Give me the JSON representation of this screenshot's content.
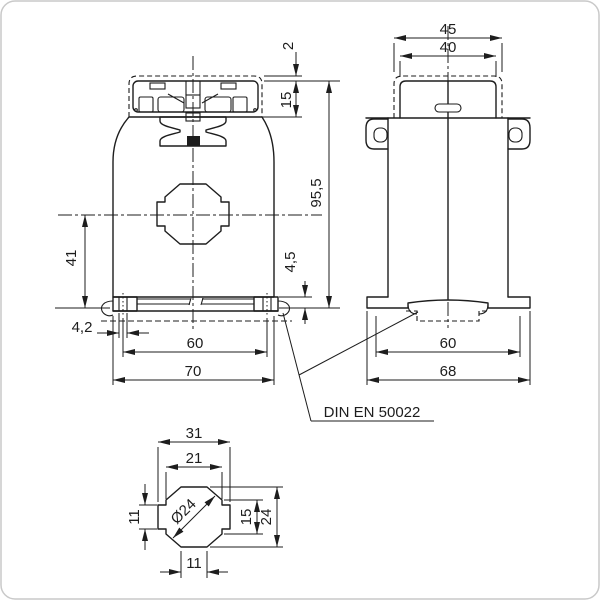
{
  "views": {
    "front": {
      "dims": {
        "gap2": "2",
        "h15": "15",
        "total": "95,5",
        "step": "4,5",
        "v41": "41",
        "slot": "4,2",
        "rail60": "60",
        "w70": "70"
      }
    },
    "side": {
      "dims": {
        "w45": "45",
        "w40": "40",
        "rail60": "60",
        "w68": "68"
      }
    },
    "detail": {
      "dims": {
        "w31": "31",
        "w21": "21",
        "dia": "Ø24",
        "h15": "15",
        "h24": "24",
        "h11": "11",
        "w11": "11"
      }
    },
    "note": {
      "standard": "DIN EN 50022"
    }
  },
  "colors": {
    "line": "#1d1d1d",
    "background": "#ffffff"
  }
}
